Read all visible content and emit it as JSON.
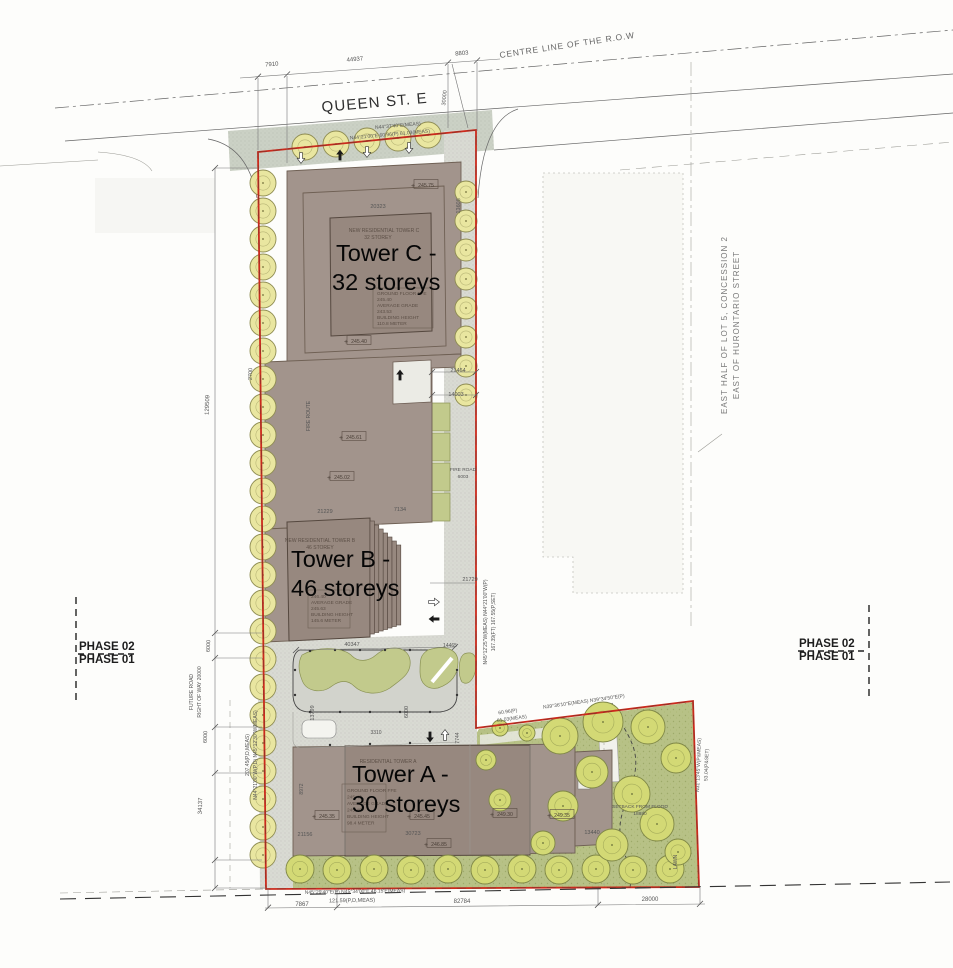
{
  "streets": {
    "queen": "QUEEN ST. E",
    "centre_line": "CENTRE LINE OF THE R.O.W"
  },
  "lot": {
    "line1": "EAST HALF OF LOT 5, CONCESSION 2",
    "line2": "EAST OF HURONTARIO STREET"
  },
  "phase": {
    "p2": "PHASE 02",
    "p1": "PHASE 01"
  },
  "towers": {
    "c": {
      "big1": "Tower C -",
      "big2": "32 storeys",
      "header": "NEW RESIDENTIAL TOWER C",
      "storeys": "32 STOREY",
      "info": [
        "GROUND FLOOR FFE",
        "245.40",
        "AVERAGE GRADE",
        "243.53",
        "BUILDING HEIGHT",
        "110.8 METER"
      ]
    },
    "b": {
      "big1": "Tower B -",
      "big2": "46 storeys",
      "header": "NEW RESIDENTIAL TOWER B",
      "storeys": "46 STOREY",
      "info": [
        "246.40",
        "AVERAGE GRADE",
        "245.63",
        "BUILDING HEIGHT",
        "145.6 METER"
      ]
    },
    "a": {
      "big1": "Tower A -",
      "big2": "30 storeys",
      "header": "RESIDENTIAL TOWER A",
      "info": [
        "GROUND FLOOR FFE",
        "245.40",
        "AVERAGE GRADE",
        "245.40",
        "BUILDING HEIGHT",
        "98.4 METER"
      ]
    }
  },
  "annotations": [
    {
      "t": "7910",
      "x": 272,
      "y": 66,
      "r": -5
    },
    {
      "t": "44937",
      "x": 355,
      "y": 61,
      "r": -5
    },
    {
      "t": "8803",
      "x": 462,
      "y": 55,
      "r": -5
    },
    {
      "t": "30000",
      "x": 446,
      "y": 98,
      "r": -84,
      "s": 5.5
    },
    {
      "t": "N44°37'40\"E(MEAS)",
      "x": 398,
      "y": 127,
      "r": -5,
      "s": 5
    },
    {
      "t": "N44°21'00\"E  60.96(P)  61.03(MEAS)",
      "x": 390,
      "y": 136,
      "r": -5,
      "s": 5
    },
    {
      "t": "13605",
      "x": 460,
      "y": 206,
      "r": -88,
      "s": 5.5
    },
    {
      "t": "20323",
      "x": 378,
      "y": 208,
      "s": 5.5
    },
    {
      "t": "2700",
      "x": 252,
      "y": 374,
      "r": -88,
      "s": 5.5
    },
    {
      "t": "129509",
      "x": 209,
      "y": 405,
      "r": -88
    },
    {
      "t": "21464",
      "x": 458,
      "y": 372,
      "s": 5.5
    },
    {
      "t": "14003",
      "x": 456,
      "y": 396,
      "s": 5.5
    },
    {
      "t": "FIRE ROAD",
      "x": 463,
      "y": 471,
      "s": 4.8
    },
    {
      "t": "6003",
      "x": 463,
      "y": 478,
      "s": 4.8
    },
    {
      "t": "FIRE ROUTE",
      "x": 310,
      "y": 416,
      "r": -90,
      "s": 5
    },
    {
      "t": "21229",
      "x": 325,
      "y": 513,
      "s": 5.5
    },
    {
      "t": "7134",
      "x": 400,
      "y": 511,
      "s": 5.5
    },
    {
      "t": "21729",
      "x": 470,
      "y": 581,
      "s": 5.5
    },
    {
      "t": "N45°12'25\"W(MEAS)   N44°21'00\"W(P)",
      "x": 487,
      "y": 622,
      "r": -90,
      "s": 5
    },
    {
      "t": "167.39(FT)   167.55(P,SET)",
      "x": 495,
      "y": 622,
      "r": -90,
      "s": 5
    },
    {
      "t": "40347",
      "x": 352,
      "y": 646,
      "s": 5.5
    },
    {
      "t": "14465",
      "x": 450,
      "y": 647,
      "s": 5
    },
    {
      "t": "13799",
      "x": 314,
      "y": 713,
      "r": -90,
      "s": 5.5
    },
    {
      "t": "6000",
      "x": 408,
      "y": 712,
      "r": -90,
      "s": 5.5
    },
    {
      "t": "3310",
      "x": 376,
      "y": 734,
      "s": 5
    },
    {
      "t": "6000",
      "x": 210,
      "y": 646,
      "r": -88,
      "s": 5.5
    },
    {
      "t": "FUTURE ROAD",
      "x": 193,
      "y": 692,
      "r": -90,
      "s": 5
    },
    {
      "t": "RIGHT OF WAY 20000",
      "x": 201,
      "y": 692,
      "r": -90,
      "s": 5
    },
    {
      "t": "6000",
      "x": 207,
      "y": 737,
      "r": -88,
      "s": 5.5
    },
    {
      "t": "207.45(P,D,MEAS)",
      "x": 249,
      "y": 755,
      "r": -90,
      "s": 5
    },
    {
      "t": "N44°21'00\"W(P,D)  N45°12'30\"W(MEAS)",
      "x": 257,
      "y": 755,
      "r": -90,
      "s": 5
    },
    {
      "t": "34137",
      "x": 202,
      "y": 806,
      "r": -88
    },
    {
      "t": "8972",
      "x": 303,
      "y": 789,
      "r": -90,
      "s": 5
    },
    {
      "t": "7744",
      "x": 459,
      "y": 738,
      "r": -90,
      "s": 5
    },
    {
      "t": "21156",
      "x": 305,
      "y": 836,
      "s": 5.5
    },
    {
      "t": "30723",
      "x": 413,
      "y": 835,
      "s": 5.5
    },
    {
      "t": "13440",
      "x": 592,
      "y": 834,
      "s": 5.5
    },
    {
      "t": "7867",
      "x": 302,
      "y": 906
    },
    {
      "t": "N45°29'40\"E(P)  N45°34'00\"E  46.15'E(MEAS)",
      "x": 355,
      "y": 893,
      "r": -1,
      "s": 5
    },
    {
      "t": "121.59(P,D,MEAS)",
      "x": 352,
      "y": 902,
      "r": -1,
      "s": 5.5
    },
    {
      "t": "82784",
      "x": 462,
      "y": 903
    },
    {
      "t": "28000",
      "x": 650,
      "y": 901
    },
    {
      "t": "60.96(P)",
      "x": 508,
      "y": 713,
      "r": -8,
      "s": 5
    },
    {
      "t": "61.03(MEAS)",
      "x": 512,
      "y": 720,
      "r": -8,
      "s": 5
    },
    {
      "t": "N39°36'10\"E(MEAS)  N39°34'50\"E(P)",
      "x": 584,
      "y": 703,
      "r": -8,
      "s": 5
    },
    {
      "t": "SETBACK FROM FLOOD",
      "x": 640,
      "y": 808,
      "s": 4.8
    },
    {
      "t": "18880",
      "x": 640,
      "y": 815,
      "s": 4.8
    },
    {
      "t": "LAWN",
      "x": 677,
      "y": 862,
      "r": -90,
      "s": 5
    },
    {
      "t": "N31°13'45\"W(P&MEAS)",
      "x": 700,
      "y": 765,
      "r": -88,
      "s": 5
    },
    {
      "t": "53.04(P&SET)",
      "x": 708,
      "y": 765,
      "r": -88,
      "s": 5
    }
  ],
  "elevation_markers": [
    {
      "v": "245.75",
      "x": 424,
      "y": 185
    },
    {
      "v": "245.40",
      "x": 357,
      "y": 341
    },
    {
      "v": "245.61",
      "x": 352,
      "y": 437
    },
    {
      "v": "245.02",
      "x": 340,
      "y": 477
    },
    {
      "v": "245.35",
      "x": 325,
      "y": 816
    },
    {
      "v": "245.45",
      "x": 420,
      "y": 816
    },
    {
      "v": "249.30",
      "x": 503,
      "y": 814
    },
    {
      "v": "249.35",
      "x": 560,
      "y": 815
    },
    {
      "v": "246.85",
      "x": 437,
      "y": 844
    }
  ],
  "colors": {
    "red": "#cb2a1c",
    "building": "#a2948c",
    "building_dark": "#97887f",
    "tree": "#e9e6a0",
    "park": "#b7c186",
    "park_tree": "#d3d975",
    "paving": "#d9dad3",
    "sidewalk": "#cbd1c5",
    "island": "#c2ca8c"
  }
}
